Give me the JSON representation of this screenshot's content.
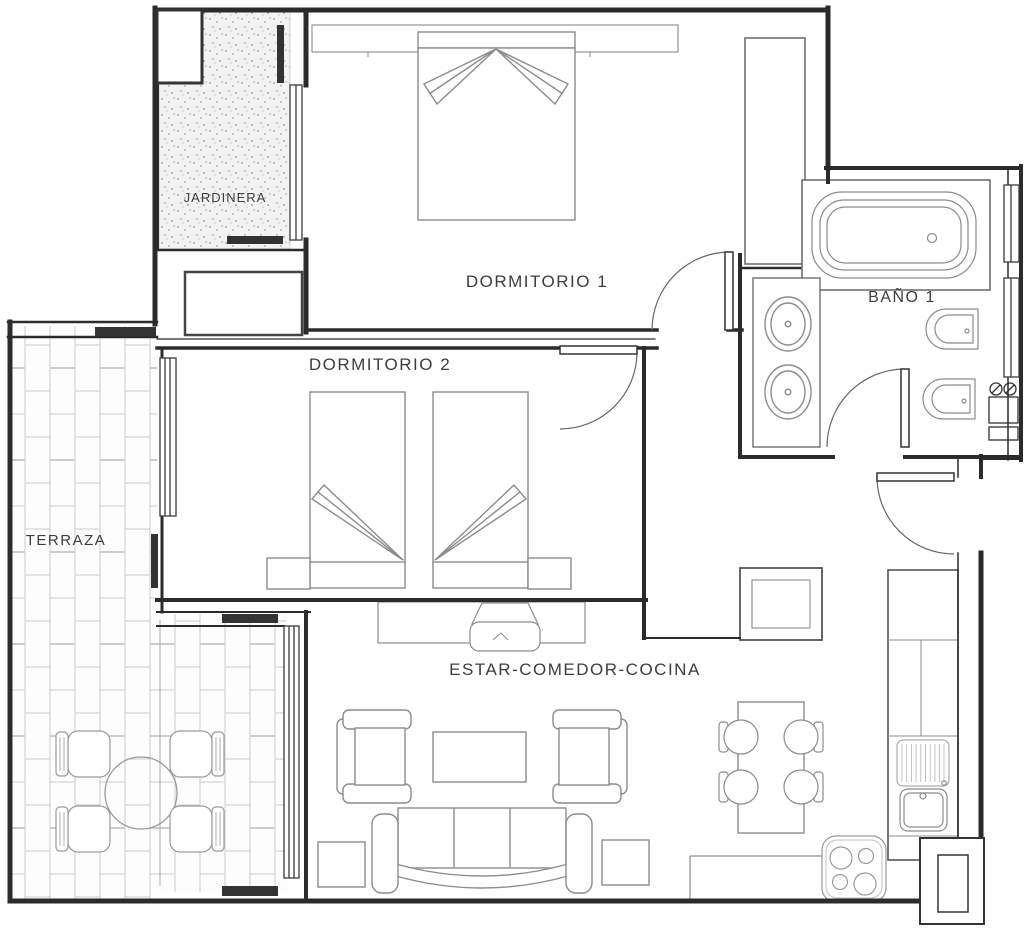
{
  "plan": {
    "type": "apartment-floor-plan",
    "labels": {
      "jardinera": "JARDINERA",
      "dormitorio1": "DORMITORIO 1",
      "dormitorio2": "DORMITORIO 2",
      "terraza": "TERRAZA",
      "bano1": "BAÑO 1",
      "estar_comedor_cocina": "ESTAR-COMEDOR-COCINA"
    },
    "colors": {
      "background": "#ffffff",
      "walls": "#2b2b2b",
      "furniture_lines": "#8c8c8c",
      "tile_lines": "#cccccc",
      "label_text": "#3d3d3d",
      "window_frames": "#333333"
    },
    "icons": [
      "double-bed-icon",
      "pillow-icon",
      "wardrobe-icon",
      "single-bed-icon",
      "nightstand-icon",
      "bathtub-icon",
      "washbasin-icon",
      "toilet-icon",
      "bidet-icon",
      "water-heater-icon",
      "tv-icon",
      "tv-console-icon",
      "armchair-icon",
      "sofa-icon",
      "coffee-table-icon",
      "side-table-icon",
      "dining-table-icon",
      "stool-icon",
      "kitchen-counter-icon",
      "refrigerator-icon",
      "kitchen-sink-icon",
      "drainboard-icon",
      "cooktop-icon",
      "oven-icon",
      "storage-cabinet-icon",
      "round-table-icon",
      "terrace-chair-icon",
      "door-swing-icon",
      "window-icon",
      "planter-icon",
      "tiled-floor-icon"
    ]
  }
}
